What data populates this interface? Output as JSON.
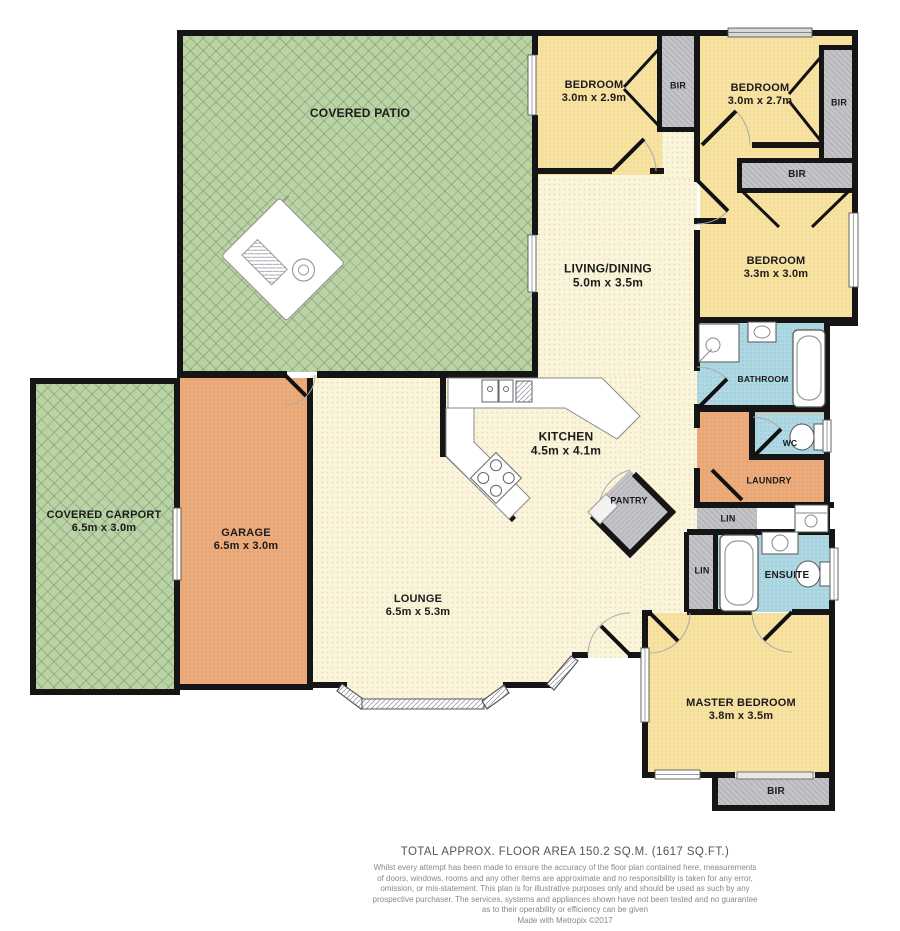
{
  "rooms": {
    "patio": {
      "name": "COVERED PATIO"
    },
    "carport": {
      "name": "COVERED CARPORT",
      "dims": "6.5m x 3.0m"
    },
    "garage": {
      "name": "GARAGE",
      "dims": "6.5m x 3.0m"
    },
    "lounge": {
      "name": "LOUNGE",
      "dims": "6.5m x 5.3m"
    },
    "kitchen": {
      "name": "KITCHEN",
      "dims": "4.5m x 4.1m"
    },
    "living": {
      "name": "LIVING/DINING",
      "dims": "5.0m x 3.5m"
    },
    "bedroom1": {
      "name": "BEDROOM",
      "dims": "3.0m x 2.9m"
    },
    "bedroom2": {
      "name": "BEDROOM",
      "dims": "3.0m x 2.7m"
    },
    "bedroom3": {
      "name": "BEDROOM",
      "dims": "3.3m x 3.0m"
    },
    "master": {
      "name": "MASTER BEDROOM",
      "dims": "3.8m x 3.5m"
    },
    "bathroom": {
      "name": "BATHROOM"
    },
    "wc": {
      "name": "WC"
    },
    "laundry": {
      "name": "LAUNDRY"
    },
    "pantry": {
      "name": "PANTRY"
    },
    "ensuite": {
      "name": "ENSUITE"
    },
    "lin1": {
      "name": "LIN"
    },
    "lin2": {
      "name": "LIN"
    },
    "bir1": {
      "name": "BIR"
    },
    "bir2": {
      "name": "BIR"
    },
    "bir3": {
      "name": "BIR"
    },
    "bir4": {
      "name": "BIR"
    }
  },
  "footer": {
    "title": "TOTAL APPROX. FLOOR AREA 150.2 SQ.M. (1617 SQ.FT.)",
    "disclaimer": [
      "Whilst every attempt has been made to ensure the accuracy of the floor plan contained here, measurements",
      "of doors, windows, rooms and any other items are approximate and no responsibility is taken for any error,",
      "omission, or mis-statement. This plan is for illustrative purposes only and should be used as such by any",
      "prospective purchaser. The services, systems and appliances shown have not been tested and no guarantee",
      "as to their operability or efficiency can be given",
      "Made with Metropix ©2017"
    ]
  },
  "colors": {
    "patio_green": "#b9d3a3",
    "bedroom_yellow": "#f7e2a2",
    "floor_cream": "#faf5da",
    "garage_orange": "#ecab7b",
    "bath_blue": "#aed8e3",
    "closet_gray": "#c4c3c7",
    "wall_black": "#151515"
  }
}
